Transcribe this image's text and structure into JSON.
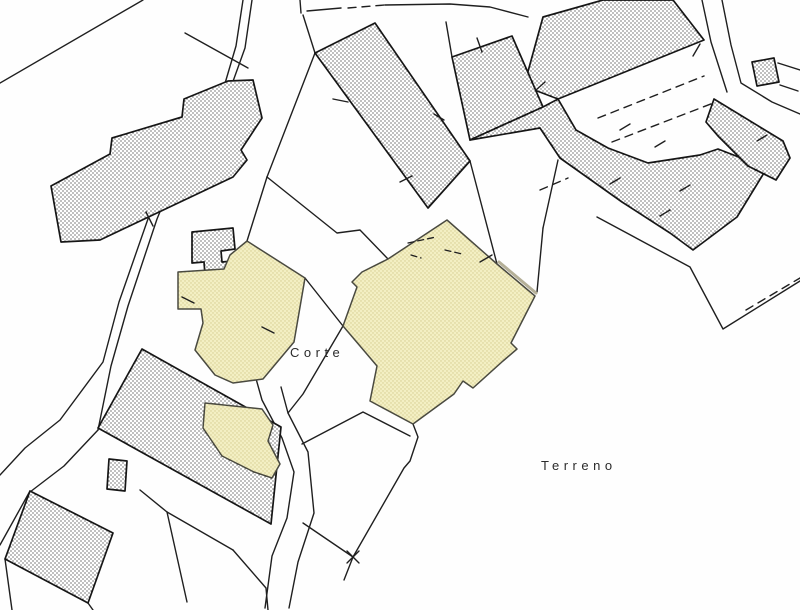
{
  "map": {
    "type": "cadastral-parcel-map",
    "labels": [
      {
        "id": "corte",
        "text": "Corte",
        "x": 290,
        "y": 357,
        "size": 13,
        "spacing": 4.5
      },
      {
        "id": "terreno",
        "text": "Terreno",
        "x": 541,
        "y": 470,
        "size": 13,
        "spacing": 4.5
      }
    ],
    "colors": {
      "background": "#fefefe",
      "line": "#1f1f1f",
      "building_outline": "#161616",
      "building_dot": "#3c3c3c",
      "building_bg": "#ffffff",
      "highlight_bg": "#f3efc3",
      "highlight_dot": "#d5cc90",
      "highlight_outline": "#4a4a40",
      "shadow": "#b5b098",
      "label": "#2b2b2b"
    },
    "boundary_lines": [
      {
        "name": "boundary-topleft-long",
        "points": "143,0 0,83"
      },
      {
        "name": "boundary-topleft-short",
        "points": "185,33 248,68"
      },
      {
        "name": "road-left-west-edge",
        "points": "243,0 236,46 221,97 204,133 167,164 149,216 119,302 103,362 60,420 25,448 0,475"
      },
      {
        "name": "road-left-east-edge",
        "points": "252,0 245,48 213,137 176,173 157,219 128,306 111,366 98,430"
      },
      {
        "name": "boundary-to-building-b",
        "points": "98,430 64,466 30,492"
      },
      {
        "name": "boundary-left-edge-b",
        "points": "0,545 30,491"
      },
      {
        "name": "boundary-below-b-1",
        "points": "5,559 12,610"
      },
      {
        "name": "boundary-below-b-2",
        "points": "88,603 93,610"
      },
      {
        "name": "boundary-top-stub",
        "points": "300,0 301,13"
      },
      {
        "name": "boundary-top-run-1",
        "points": "307,11 341,8"
      },
      {
        "name": "boundary-top-run-dashed",
        "points": "348,8 385,5",
        "dashed": true
      },
      {
        "name": "boundary-top-run-2",
        "points": "385,5 450,4 490,7 528,17"
      },
      {
        "name": "boundary-b2-connector",
        "points": "315,53 303,15"
      },
      {
        "name": "boundary-c2-connector",
        "points": "452,57 446,22"
      },
      {
        "name": "boundary-c1-connector",
        "points": "524,86 543,107"
      },
      {
        "name": "boundary-vertex-up",
        "points": "267,177 315,53"
      },
      {
        "name": "boundary-vertex-to-corte",
        "points": "267,177 247,241"
      },
      {
        "name": "boundary-vertex-east",
        "points": "267,177 337,233 360,230 388,259"
      },
      {
        "name": "boundary-corte-1",
        "points": "305,278 343,326"
      },
      {
        "name": "boundary-corte-2",
        "points": "343,326 303,394 288,413"
      },
      {
        "name": "road-curve-west-edge",
        "points": "253,368 262,400 282,438 294,472 287,518 272,556 265,608"
      },
      {
        "name": "road-curve-east-edge",
        "points": "281,387 288,413 308,452 314,513 298,562 289,608"
      },
      {
        "name": "boundary-offset-south",
        "points": "302,444 363,412 410,436"
      },
      {
        "name": "boundary-south-jagged",
        "points": "413,424 418,437 410,461 404,468 353,557"
      },
      {
        "name": "boundary-south-west",
        "points": "303,523 353,557"
      },
      {
        "name": "boundary-south-tail",
        "points": "353,557 344,580"
      },
      {
        "name": "boundary-alley-east",
        "points": "470,161 497,264"
      },
      {
        "name": "boundary-right-of-parcel",
        "points": "543,228 537,292"
      },
      {
        "name": "boundary-right-up",
        "points": "543,228 558,160"
      },
      {
        "name": "boundary-terreno-north",
        "points": "597,217 690,267 723,329 800,281"
      },
      {
        "name": "boundary-bottom-1",
        "points": "140,490 167,512 233,550"
      },
      {
        "name": "boundary-bottom-2",
        "points": "167,512 187,602"
      },
      {
        "name": "boundary-bottom-3",
        "points": "233,550 266,588 268,610"
      },
      {
        "name": "road-topright-west",
        "points": "702,0 711,42 727,92"
      },
      {
        "name": "road-topright-east",
        "points": "722,0 731,45 741,83 772,102 800,114"
      },
      {
        "name": "square-bracket-1",
        "points": "778,63 800,70"
      },
      {
        "name": "square-bracket-2",
        "points": "780,85 798,91"
      },
      {
        "name": "dashes-upper-right-a",
        "points": "598,118 704,76",
        "dashed": true
      },
      {
        "name": "dashes-upper-right-b",
        "points": "612,142 716,102",
        "dashed": true
      },
      {
        "name": "dash-mid-right",
        "points": "540,190 568,178",
        "dashed": true
      },
      {
        "name": "dashes-lower-right",
        "points": "746,310 800,278",
        "dashed": true
      }
    ],
    "buildings": [
      {
        "name": "building-upper-left-stepped",
        "points": "51,186 110,154 112,138 182,117 184,99 228,81 253,80 262,118 241,150 247,160 233,177 100,240 61,242"
      },
      {
        "name": "building-top-center",
        "points": "315,53 375,23 470,161 428,208"
      },
      {
        "name": "building-topright-band",
        "points": "524,86 543,17 603,0 673,0 704,40 558,99"
      },
      {
        "name": "building-topright-upper",
        "points": "452,57 512,36 543,107 470,140"
      },
      {
        "name": "building-topright-mass",
        "points": "470,140 543,107 558,99 576,130 608,148 648,163 700,155 718,149 767,168 737,217 693,250 670,233 622,202 560,158 540,128"
      },
      {
        "name": "building-right-parallelogram",
        "points": "714,99 783,141 790,158 776,180 748,166 718,136 706,122"
      },
      {
        "name": "building-topright-square",
        "points": "752,62 774,58 779,82 757,86"
      },
      {
        "name": "building-bottomleft-large",
        "points": "142,349 281,427 271,524 98,428"
      },
      {
        "name": "building-bottomleft-small",
        "points": "30,491 113,533 88,603 5,559"
      },
      {
        "name": "building-bottomleft-annex",
        "points": "109,459 127,461 125,491 107,489"
      },
      {
        "name": "building-near-corte-small",
        "points": "192,232 233,228 235,249 221,251 222,262 243,260 244,272 205,275 204,262 192,263"
      }
    ],
    "highlight_parcels": [
      {
        "name": "highlight-parcel-corte-west",
        "points": "247,241 305,278 294,342 263,379 233,383 215,375 195,350 203,323 201,309 178,309 178,272 224,269 230,255"
      },
      {
        "name": "highlight-parcel-center",
        "points": "447,220 497,264 535,296 511,343 517,349 503,361 473,388 463,381 454,394 413,424 370,401 377,366 343,326 357,287 352,282 362,272 388,259"
      },
      {
        "name": "highlight-parcel-corte-south",
        "points": "205,403 262,409 273,425 268,441 280,464 272,478 254,472 222,456 203,428"
      }
    ],
    "overlay_lines": [
      {
        "name": "parcel-shadow-edge",
        "points": "499,262 536,293",
        "w": 3,
        "color": "#b5b098"
      },
      {
        "name": "interior-dash-1",
        "points": "408,243 436,237",
        "dashed": true
      },
      {
        "name": "interior-dash-2",
        "points": "445,250 462,254",
        "dashed": true
      },
      {
        "name": "interior-dash-3",
        "points": "411,255 421,258",
        "dashed": true
      }
    ],
    "tick_marks": [
      "146,212 153,226",
      "333,99 348,102",
      "400,182 412,176",
      "480,262 492,255",
      "262,327 274,333",
      "182,297 194,303",
      "700,44 693,56",
      "477,38 482,52",
      "536,90 545,82",
      "620,130 630,124",
      "655,147 665,141",
      "610,184 620,178",
      "680,191 690,185",
      "757,141 767,135",
      "660,216 670,210",
      "434,114 444,120",
      "347,551 359,563",
      "359,551 347,563"
    ]
  }
}
